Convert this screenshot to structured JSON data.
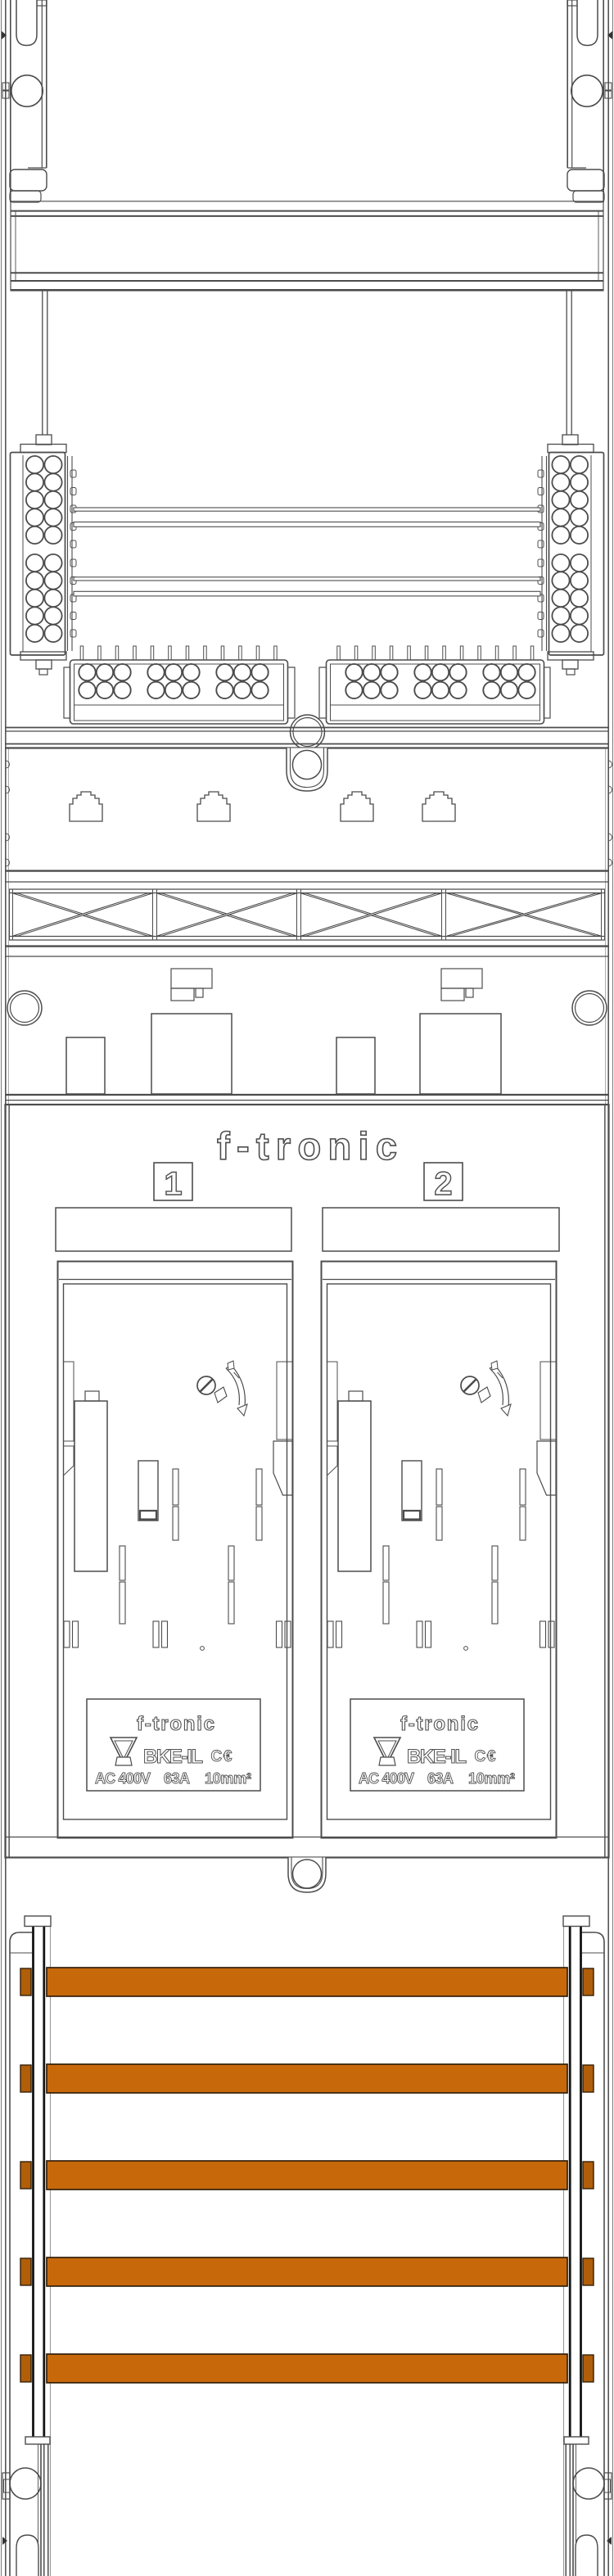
{
  "drawing": {
    "kind": "meter-board technical drawing",
    "fields_count": "2"
  },
  "brand": {
    "name": "f-tronic"
  },
  "fields": [
    {
      "number": "1"
    },
    {
      "number": "2"
    }
  ],
  "nameplate": {
    "brand": "f-tronic",
    "model": "BKE-IL",
    "ce_mark": "C€",
    "rating_voltage": "AC 400V",
    "rating_current": "63A",
    "rating_wire": "10mm²"
  },
  "icons": {
    "approval": "vde-triangle-icon",
    "screw": "sealing-screw-icon",
    "arrow": "rotation-arrow-icon"
  },
  "colors": {
    "busbar": "#c7690b",
    "busbar_end": "#b05e09",
    "line": "#4c4c4c",
    "rail_dark": "#151515",
    "text_outline": "#4f4f4f"
  }
}
